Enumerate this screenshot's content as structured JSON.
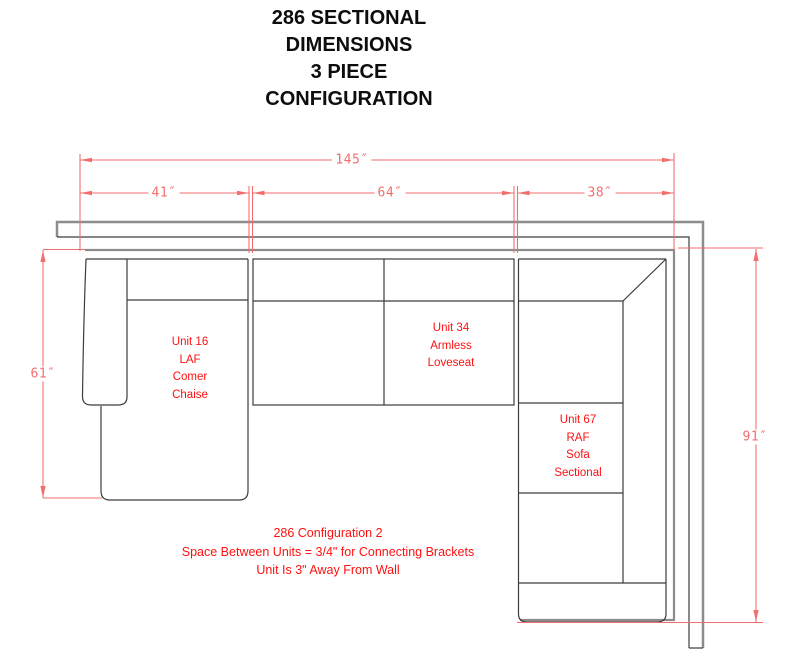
{
  "title": "286 SECTIONAL\nDIMENSIONS\n3 PIECE\nCONFIGURATION",
  "dimensions": {
    "total_width": "145″",
    "chaise_width": "41″",
    "loveseat_width": "64″",
    "sofa_width": "38″",
    "left_depth": "61″",
    "right_depth": "91″"
  },
  "units": [
    {
      "id": "unit-16",
      "label": "Unit 16\nLAF\nComer\nChaise"
    },
    {
      "id": "unit-34",
      "label": "Unit 34\nArmless\nLoveseat"
    },
    {
      "id": "unit-67",
      "label": "Unit 67\nRAF\nSofa\nSectional"
    }
  ],
  "notes": "286 Configuration 2\nSpace Between Units = 3/4\" for Connecting Brackets\nUnit Is 3\" Away From Wall",
  "colors": {
    "dim": "#f26e6e",
    "label": "#ff1010",
    "outline": "#8c8c8c",
    "unit_line": "#3c3c3c",
    "title": "#0d0d0d"
  }
}
